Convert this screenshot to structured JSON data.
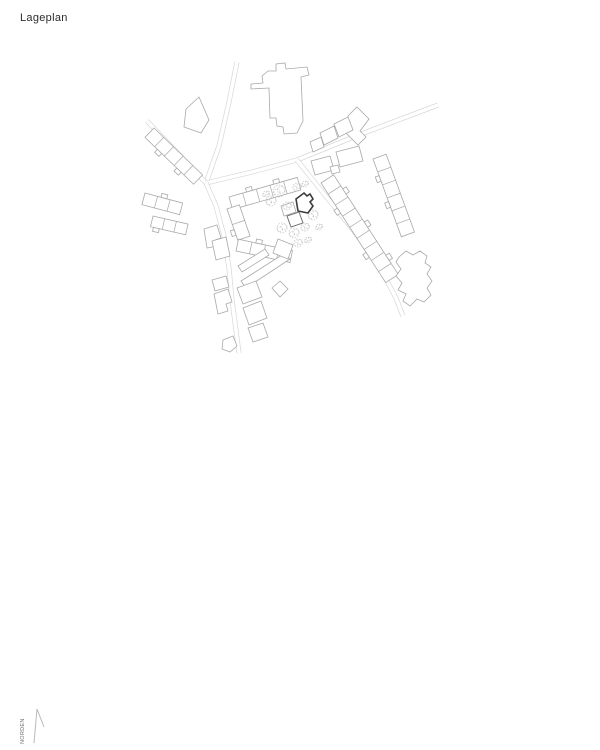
{
  "title": "Lageplan",
  "north_label": "NORDEN",
  "colors": {
    "background": "#ffffff",
    "building_line": "#a9a9a9",
    "secondary_line": "#747474",
    "highlight_line": "#3c3c3c",
    "road_line": "#d7d7d7",
    "tree_line": "#c6c6c6",
    "title_text": "#2b2b2b",
    "north_text": "#6e6e6e",
    "arrow_line": "#b9b9b9"
  },
  "plan": {
    "roads": [
      {
        "name": "street-north",
        "points": [
          [
            237,
            62
          ],
          [
            229,
            102
          ],
          [
            219,
            146
          ],
          [
            206,
            183
          ]
        ]
      },
      {
        "name": "street-west",
        "points": [
          [
            147,
            121
          ],
          [
            168,
            143
          ],
          [
            206,
            183
          ]
        ]
      },
      {
        "name": "street-northeast",
        "points": [
          [
            206,
            183
          ],
          [
            252,
            172
          ],
          [
            297,
            160
          ],
          [
            356,
            136
          ],
          [
            438,
            105
          ]
        ]
      },
      {
        "name": "street-southeast",
        "points": [
          [
            297,
            160
          ],
          [
            320,
            189
          ],
          [
            350,
            226
          ],
          [
            377,
            262
          ],
          [
            396,
            298
          ],
          [
            403,
            316
          ]
        ]
      },
      {
        "name": "street-south",
        "points": [
          [
            206,
            183
          ],
          [
            216,
            206
          ],
          [
            224,
            236
          ],
          [
            229,
            268
          ],
          [
            232,
            300
          ],
          [
            239,
            353
          ]
        ]
      }
    ],
    "rows": [
      {
        "name": "row-nw-terrace",
        "start": [
          154,
          128
        ],
        "angle": 44,
        "segments": 5,
        "seg_len": 13.5,
        "width": -13,
        "bumps_far": [
          1,
          3
        ],
        "bumps_near": []
      },
      {
        "name": "row-west-terrace-a",
        "start": [
          145,
          193
        ],
        "angle": 15,
        "segments": 3,
        "seg_len": 13,
        "width": -12,
        "bumps_far": [],
        "bumps_near": [
          1
        ]
      },
      {
        "name": "row-west-terrace-b",
        "start": [
          153,
          216
        ],
        "angle": 13,
        "segments": 3,
        "seg_len": 12,
        "width": -11,
        "bumps_far": [
          0
        ],
        "bumps_near": []
      },
      {
        "name": "block-north-row",
        "start": [
          229,
          197
        ],
        "angle": -16,
        "segments": 5,
        "seg_len": 14.2,
        "width": -13,
        "bumps_far": [],
        "bumps_near": [
          1,
          3
        ]
      },
      {
        "name": "block-west-row",
        "start": [
          227,
          209
        ],
        "angle": 71,
        "segments": 2,
        "seg_len": 16.5,
        "width": 13,
        "bumps_far": [],
        "bumps_near": [
          1
        ]
      },
      {
        "name": "block-south-row",
        "start": [
          236,
          251
        ],
        "angle": 12,
        "segments": 4,
        "seg_len": 13.8,
        "width": 12,
        "bumps_far": [
          1
        ],
        "bumps_near": []
      },
      {
        "name": "rowhouse-band-southeast",
        "start": [
          321,
          183
        ],
        "angle": 57,
        "segments": 9,
        "seg_len": 13.2,
        "width": 15,
        "bumps_far": [
          1,
          4,
          7
        ],
        "bumps_near": [
          2,
          6
        ]
      },
      {
        "name": "rowhouse-band-east",
        "start": [
          373,
          159
        ],
        "angle": 70,
        "segments": 6,
        "seg_len": 13.8,
        "width": 14,
        "bumps_far": [],
        "bumps_near": [
          1,
          3
        ]
      }
    ],
    "buildings": [
      {
        "name": "building-northwest-trapezoid",
        "points": [
          [
            186,
            109
          ],
          [
            199,
            97
          ],
          [
            209,
            120
          ],
          [
            201,
            133
          ],
          [
            184,
            127
          ]
        ]
      },
      {
        "name": "building-west-small-notch",
        "points": [
          [
            204,
            229
          ],
          [
            217,
            225
          ],
          [
            221,
            238
          ],
          [
            215,
            240
          ],
          [
            217,
            246
          ],
          [
            207,
            248
          ]
        ]
      },
      {
        "name": "building-large-north-t",
        "points": [
          [
            251,
            84
          ],
          [
            263,
            83
          ],
          [
            262,
            76
          ],
          [
            268,
            71
          ],
          [
            276,
            71
          ],
          [
            276,
            64
          ],
          [
            285,
            63
          ],
          [
            286,
            69
          ],
          [
            307,
            67
          ],
          [
            309,
            75
          ],
          [
            301,
            77
          ],
          [
            303,
            121
          ],
          [
            297,
            133
          ],
          [
            284,
            134
          ],
          [
            283,
            127
          ],
          [
            277,
            126
          ],
          [
            276,
            118
          ],
          [
            270,
            118
          ],
          [
            269,
            88
          ],
          [
            251,
            89
          ]
        ]
      },
      {
        "name": "building-northeast-l",
        "points": [
          [
            348,
            116
          ],
          [
            357,
            107
          ],
          [
            369,
            119
          ],
          [
            360,
            131
          ],
          [
            366,
            137
          ],
          [
            358,
            145
          ],
          [
            346,
            133
          ],
          [
            352,
            127
          ],
          [
            347,
            122
          ]
        ]
      },
      {
        "name": "building-ne-chain-1",
        "points": [
          [
            334,
            124
          ],
          [
            348,
            117
          ],
          [
            353,
            130
          ],
          [
            339,
            137
          ]
        ]
      },
      {
        "name": "building-ne-chain-2",
        "points": [
          [
            320,
            133
          ],
          [
            334,
            126
          ],
          [
            338,
            138
          ],
          [
            324,
            145
          ]
        ]
      },
      {
        "name": "building-ne-chain-3",
        "points": [
          [
            310,
            142
          ],
          [
            321,
            137
          ],
          [
            324,
            147
          ],
          [
            313,
            152
          ]
        ]
      },
      {
        "name": "building-ne-south-1",
        "points": [
          [
            311,
            161
          ],
          [
            330,
            156
          ],
          [
            334,
            170
          ],
          [
            315,
            175
          ]
        ]
      },
      {
        "name": "building-ne-south-2",
        "points": [
          [
            336,
            152
          ],
          [
            359,
            146
          ],
          [
            363,
            161
          ],
          [
            340,
            167
          ]
        ]
      },
      {
        "name": "building-ne-south-3",
        "points": [
          [
            330,
            167
          ],
          [
            338,
            165
          ],
          [
            340,
            172
          ],
          [
            332,
            174
          ]
        ]
      },
      {
        "name": "building-east-irregular",
        "points": [
          [
            399,
            257
          ],
          [
            406,
            251
          ],
          [
            413,
            255
          ],
          [
            420,
            251
          ],
          [
            427,
            256
          ],
          [
            425,
            263
          ],
          [
            431,
            267
          ],
          [
            427,
            274
          ],
          [
            432,
            281
          ],
          [
            427,
            288
          ],
          [
            431,
            295
          ],
          [
            424,
            302
          ],
          [
            417,
            299
          ],
          [
            410,
            306
          ],
          [
            403,
            301
          ],
          [
            406,
            294
          ],
          [
            398,
            290
          ],
          [
            402,
            283
          ],
          [
            396,
            276
          ],
          [
            401,
            269
          ],
          [
            396,
            262
          ]
        ]
      },
      {
        "name": "wall-strip-a",
        "points": [
          [
            238,
            266
          ],
          [
            265,
            249
          ],
          [
            269,
            255
          ],
          [
            242,
            272
          ]
        ]
      },
      {
        "name": "wall-strip-b",
        "points": [
          [
            241,
            281
          ],
          [
            285,
            253
          ],
          [
            290,
            259
          ],
          [
            246,
            288
          ]
        ]
      },
      {
        "name": "building-strip-end",
        "points": [
          [
            278,
            239
          ],
          [
            293,
            245
          ],
          [
            288,
            259
          ],
          [
            273,
            253
          ]
        ]
      },
      {
        "name": "building-small-diamond",
        "points": [
          [
            272,
            288
          ],
          [
            280,
            281
          ],
          [
            288,
            289
          ],
          [
            280,
            297
          ]
        ]
      },
      {
        "name": "building-south-road-1",
        "points": [
          [
            237,
            288
          ],
          [
            256,
            281
          ],
          [
            262,
            297
          ],
          [
            243,
            304
          ]
        ]
      },
      {
        "name": "building-south-road-2",
        "points": [
          [
            243,
            308
          ],
          [
            261,
            301
          ],
          [
            267,
            318
          ],
          [
            249,
            325
          ]
        ]
      },
      {
        "name": "building-south-road-3",
        "points": [
          [
            248,
            328
          ],
          [
            263,
            323
          ],
          [
            268,
            337
          ],
          [
            253,
            342
          ]
        ]
      },
      {
        "name": "building-road-west-1",
        "points": [
          [
            212,
            241
          ],
          [
            226,
            237
          ],
          [
            230,
            256
          ],
          [
            216,
            260
          ]
        ]
      },
      {
        "name": "building-road-west-2",
        "points": [
          [
            214,
            294
          ],
          [
            228,
            289
          ],
          [
            232,
            302
          ],
          [
            226,
            304
          ],
          [
            228,
            311
          ],
          [
            218,
            314
          ]
        ]
      },
      {
        "name": "building-road-west-3",
        "points": [
          [
            212,
            280
          ],
          [
            226,
            276
          ],
          [
            229,
            287
          ],
          [
            215,
            291
          ]
        ]
      },
      {
        "name": "building-south-pentagon",
        "points": [
          [
            223,
            340
          ],
          [
            233,
            336
          ],
          [
            237,
            346
          ],
          [
            230,
            352
          ],
          [
            222,
            349
          ]
        ]
      },
      {
        "name": "building-block-east-small",
        "points": [
          [
            281,
            206
          ],
          [
            293,
            202
          ],
          [
            296,
            212
          ],
          [
            284,
            216
          ]
        ]
      },
      {
        "name": "building-annex",
        "tone": "secondary",
        "points": [
          [
            287,
            216
          ],
          [
            299,
            212
          ],
          [
            303,
            223
          ],
          [
            291,
            227
          ]
        ]
      }
    ],
    "highlight": {
      "name": "highlighted-building",
      "points": [
        [
          296,
          199
        ],
        [
          304,
          193
        ],
        [
          307,
          196
        ],
        [
          310,
          194
        ],
        [
          313,
          199
        ],
        [
          310,
          202
        ],
        [
          313,
          206
        ],
        [
          308,
          213
        ],
        [
          298,
          211
        ]
      ]
    },
    "trees": [
      [
        279,
        191,
        6
      ],
      [
        271,
        201,
        5
      ],
      [
        287,
        206,
        4
      ],
      [
        297,
        187,
        4
      ],
      [
        305,
        184,
        3
      ],
      [
        266,
        194,
        3
      ],
      [
        282,
        228,
        5
      ],
      [
        294,
        233,
        5
      ],
      [
        305,
        227,
        4
      ],
      [
        313,
        215,
        5
      ],
      [
        319,
        227,
        3
      ],
      [
        298,
        243,
        4
      ],
      [
        308,
        240,
        3
      ]
    ],
    "north_arrow": {
      "points": [
        [
          4,
          38
        ],
        [
          7,
          4
        ],
        [
          14,
          22
        ]
      ]
    }
  }
}
